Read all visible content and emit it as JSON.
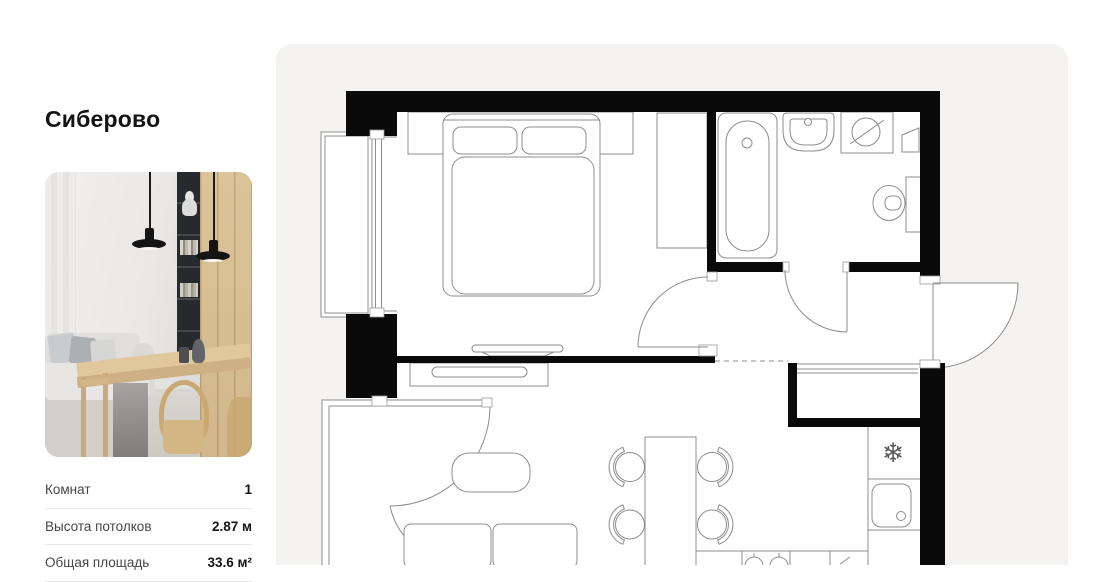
{
  "sidebar": {
    "title": "Сиберово",
    "specs": [
      {
        "label": "Комнат",
        "value": "1"
      },
      {
        "label": "Высота потолков",
        "value": "2.87 м"
      },
      {
        "label": "Общая площадь",
        "value": "33.6 м²"
      }
    ]
  },
  "floorplan": {
    "card_color": "#f4f3f1",
    "wall_color": "#0a0a0a",
    "line_color": "#8d8d8d",
    "fridge_icon_glyph": "❄"
  }
}
